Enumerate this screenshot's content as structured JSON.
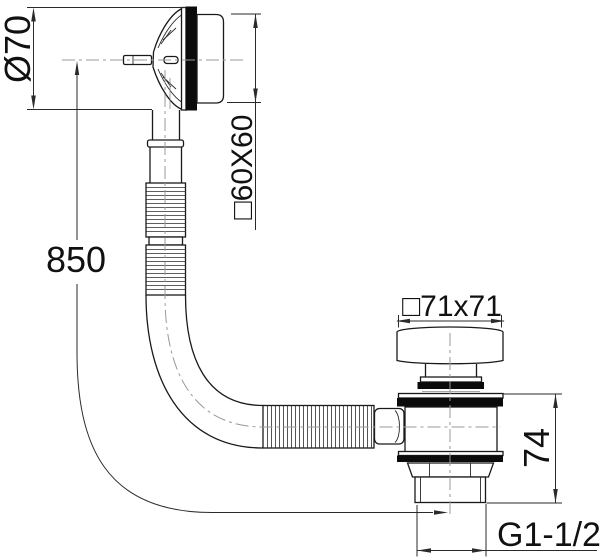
{
  "drawing": {
    "type": "technical-dimension-drawing",
    "subject": "bath-waste-overflow-with-flexible-hose-and-click-drain",
    "colors": {
      "background": "#ffffff",
      "line": "#1a1a1a",
      "gasket_fill": "#0b0b0b",
      "centerline": "#999999",
      "dimension": "#2a2a2a"
    },
    "labels": {
      "overflow_diameter": "Ø70",
      "overflow_faceplate": "□60X60",
      "hose_length": "850",
      "drain_flange": "□71x71",
      "drain_body_height": "74",
      "outlet_thread": "G1-1/2"
    }
  }
}
